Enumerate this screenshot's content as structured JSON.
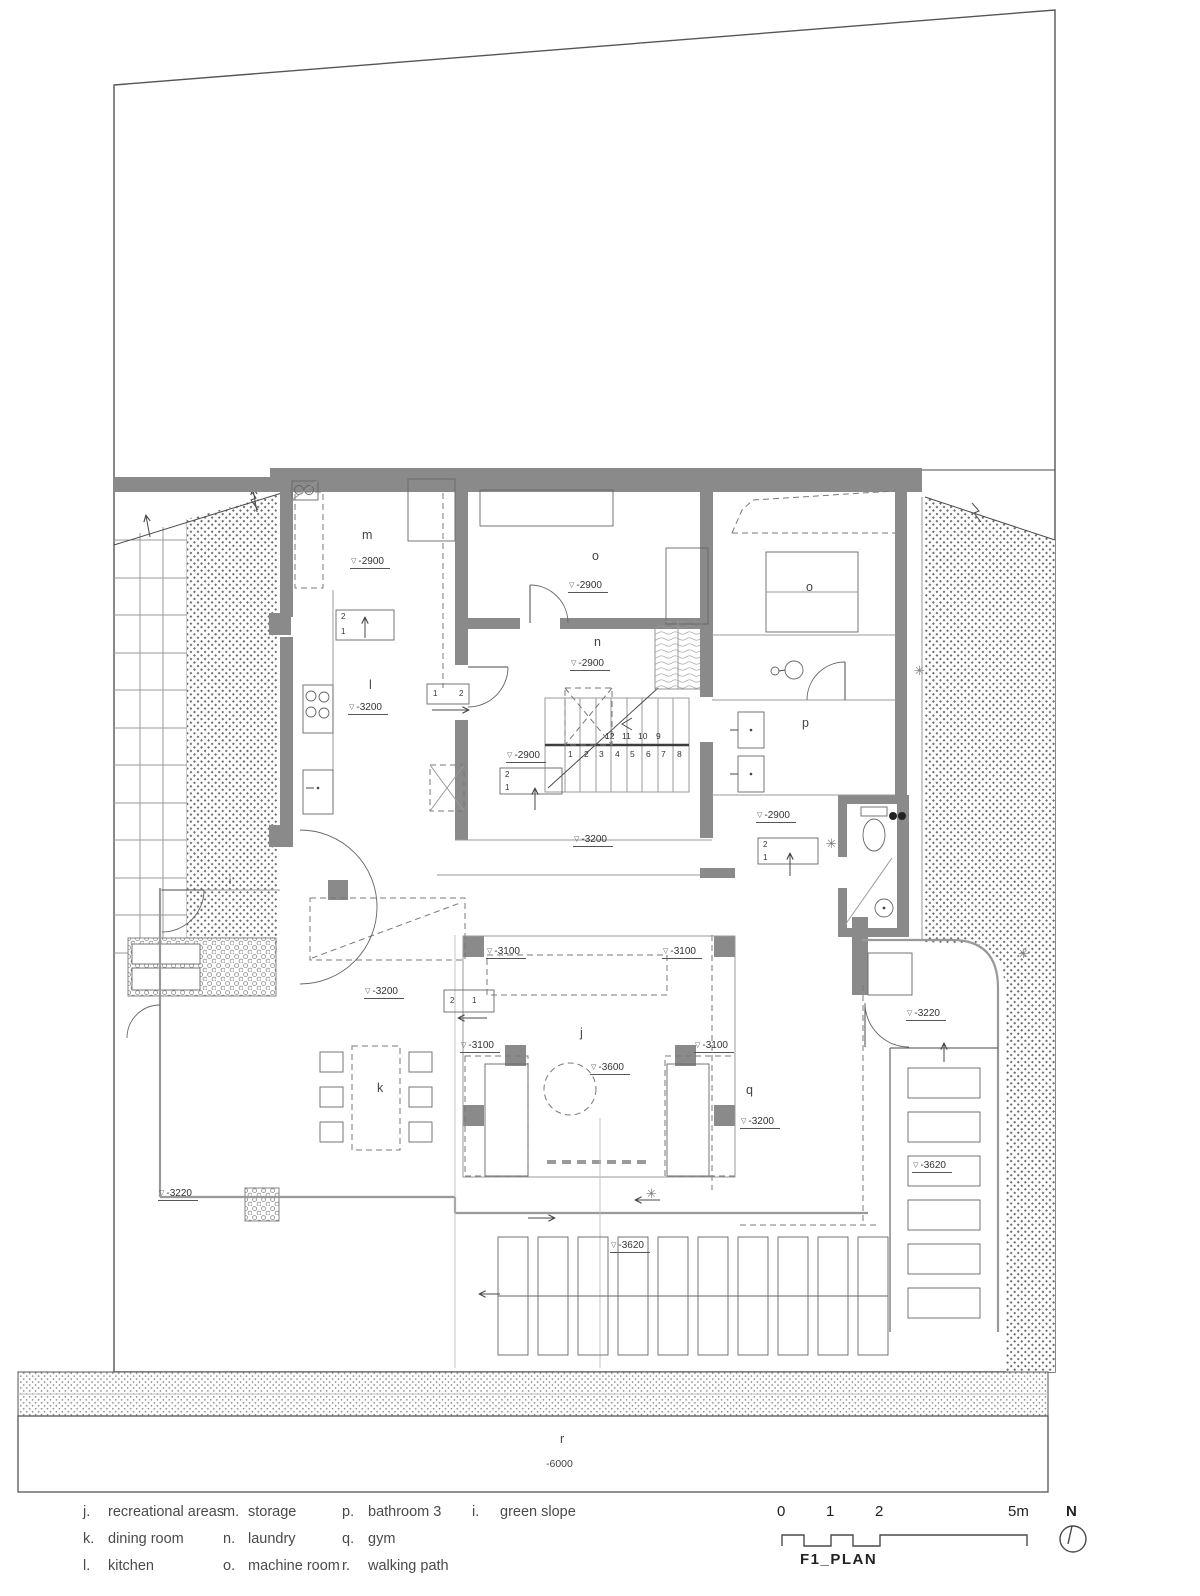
{
  "colors": {
    "wall_fill": "#8a8a8a",
    "line_dark": "#4a4a4a",
    "line_light": "#999999",
    "hatch_dot": "#6e6e6e"
  },
  "plan": {
    "room_labels": {
      "m": "m",
      "l": "l",
      "o1": "o",
      "n": "n",
      "o2": "o",
      "p": "p",
      "j": "j",
      "k": "k",
      "q": "q",
      "r": "r",
      "i": "i"
    },
    "elevations": {
      "m": "-2900",
      "o1": "-2900",
      "n": "-2900",
      "l": "-3200",
      "hall_mid": "-2900",
      "hall_low": "-3200",
      "lobby": "-2900",
      "court_tl": "-3100",
      "court_tr": "-3100",
      "court_ml": "-3100",
      "court_mr": "-3100",
      "court_center": "-3600",
      "dining": "-3200",
      "gym": "-3200",
      "terrace_right": "-3220",
      "stones_right": "-3620",
      "deck": "-3620",
      "terrace_left": "-3220",
      "path": "-6000"
    },
    "stairs": {
      "upper_run": [
        "12",
        "11",
        "10",
        "9"
      ],
      "lower_run": [
        "1",
        "2",
        "3",
        "4",
        "5",
        "6",
        "7",
        "8"
      ]
    },
    "marker": {
      "one": "1",
      "two": "2"
    }
  },
  "legend": {
    "items": [
      {
        "key": "j.",
        "label": "recreational areas"
      },
      {
        "key": "k.",
        "label": "dining room"
      },
      {
        "key": "l.",
        "label": "kitchen"
      },
      {
        "key": "m.",
        "label": "storage"
      },
      {
        "key": "n.",
        "label": "laundry"
      },
      {
        "key": "o.",
        "label": "machine room"
      },
      {
        "key": "p.",
        "label": "bathroom 3"
      },
      {
        "key": "q.",
        "label": "gym"
      },
      {
        "key": "r.",
        "label": "walking path"
      },
      {
        "key": "i.",
        "label": "green slope"
      }
    ]
  },
  "footer": {
    "ticks": [
      "0",
      "1",
      "2",
      "5m"
    ],
    "north": "N",
    "title": "F1_PLAN"
  },
  "icons": {
    "tree": "✳"
  }
}
